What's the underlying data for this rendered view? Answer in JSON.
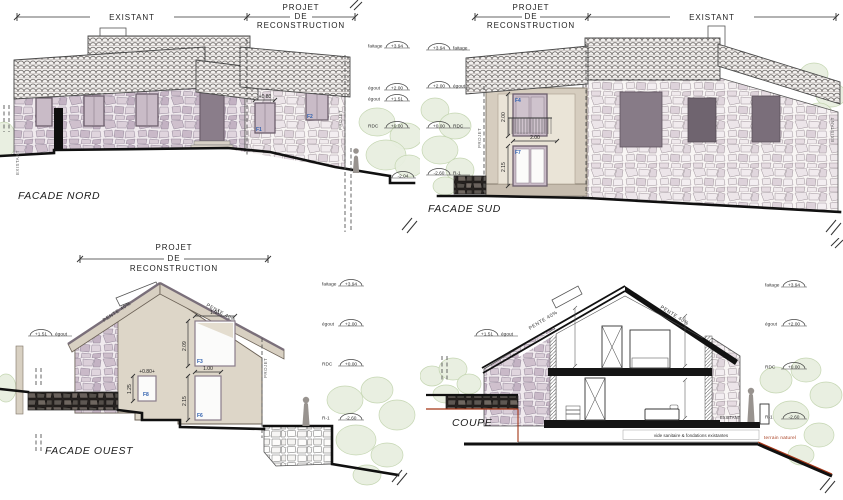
{
  "sheet": {
    "background": "#ffffff"
  },
  "colors": {
    "label_blue": "#2e5fae",
    "terrain_red": "#a33415",
    "ink": "#1d1d1d",
    "stone_purple": "#cdbfcb",
    "wall_beige": "#d9d1c3",
    "green_light": "#e8efe0"
  },
  "nord": {
    "title": "FACADE NORD",
    "header_existant": "EXISTANT",
    "header_projet": [
      "PROJET",
      "DE",
      "RECONSTRUCTION"
    ],
    "side_existant": "EXISTANT",
    "side_projet": "PROJET",
    "dim_win_mid": "+0.80",
    "dim_win_right": "+0.80",
    "win_mid_label": "F1",
    "win_right_label": "F2",
    "levels": [
      {
        "label": "faitage",
        "value": "+3.94"
      },
      {
        "label": "égout",
        "value": "+2.00"
      },
      {
        "label": "égout",
        "value": "+1.51"
      },
      {
        "label": "RDC",
        "value": "+0.00"
      },
      {
        "label": "",
        "value": "-2.04"
      }
    ]
  },
  "sud": {
    "title": "FACADE SUD",
    "header_projet": [
      "PROJET",
      "DE",
      "RECONSTRUCTION"
    ],
    "header_existant": "EXISTANT",
    "side_projet": "PROJET",
    "side_existant": "EXISTANT",
    "win_upper_label": "F4",
    "win_lower_label": "F7",
    "dim_upper_h": "2.00",
    "dim_upper_w": "2.00",
    "dim_lower_h": "2.15",
    "levels": [
      {
        "label": "faitage",
        "value": "+3.94"
      },
      {
        "label": "égout",
        "value": "+2.00"
      },
      {
        "label": "RDC",
        "value": "+0.00"
      },
      {
        "label": "R-1",
        "value": "-2.60"
      }
    ]
  },
  "ouest": {
    "title": "FACADE OUEST",
    "header_projet": [
      "PROJET",
      "DE",
      "RECONSTRUCTION"
    ],
    "side_projet": "PROJET",
    "pente_left": "PENTE 40%",
    "pente_right": "PENTE 40%",
    "egout_left_value": "+1.51",
    "egout_left_label": "égout",
    "win_f3_label": "F3",
    "win_f8_label": "F8",
    "win_f6_label": "F6",
    "dim_f3_w": "1.91",
    "dim_f3_h": "2.09",
    "dim_f8_w": "+0.80+",
    "dim_f8_h": "1.25",
    "dim_f6_w": "1.00",
    "dim_f6_h": "2.15",
    "levels": [
      {
        "label": "faitage",
        "value": "+3.94"
      },
      {
        "label": "égout",
        "value": "+2.00"
      },
      {
        "label": "RDC",
        "value": "+0.00"
      },
      {
        "label": "R-1",
        "value": "-2.60"
      }
    ]
  },
  "coupe": {
    "title": "COUPE",
    "pente_left": "PENTE 40%",
    "pente_right": "PENTE 40%",
    "egout_left_value": "+1.51",
    "egout_left_label": "égout",
    "note_vide": "vide sanitaire & fondations existantes",
    "note_terrain": "terrain naturel",
    "note_existant": "EXISTANT",
    "levels": [
      {
        "label": "faitage",
        "value": "+3.94"
      },
      {
        "label": "égout",
        "value": "+2.00"
      },
      {
        "label": "RDC",
        "value": "+0.00"
      },
      {
        "label": "R-1",
        "value": "-2.60"
      }
    ]
  }
}
